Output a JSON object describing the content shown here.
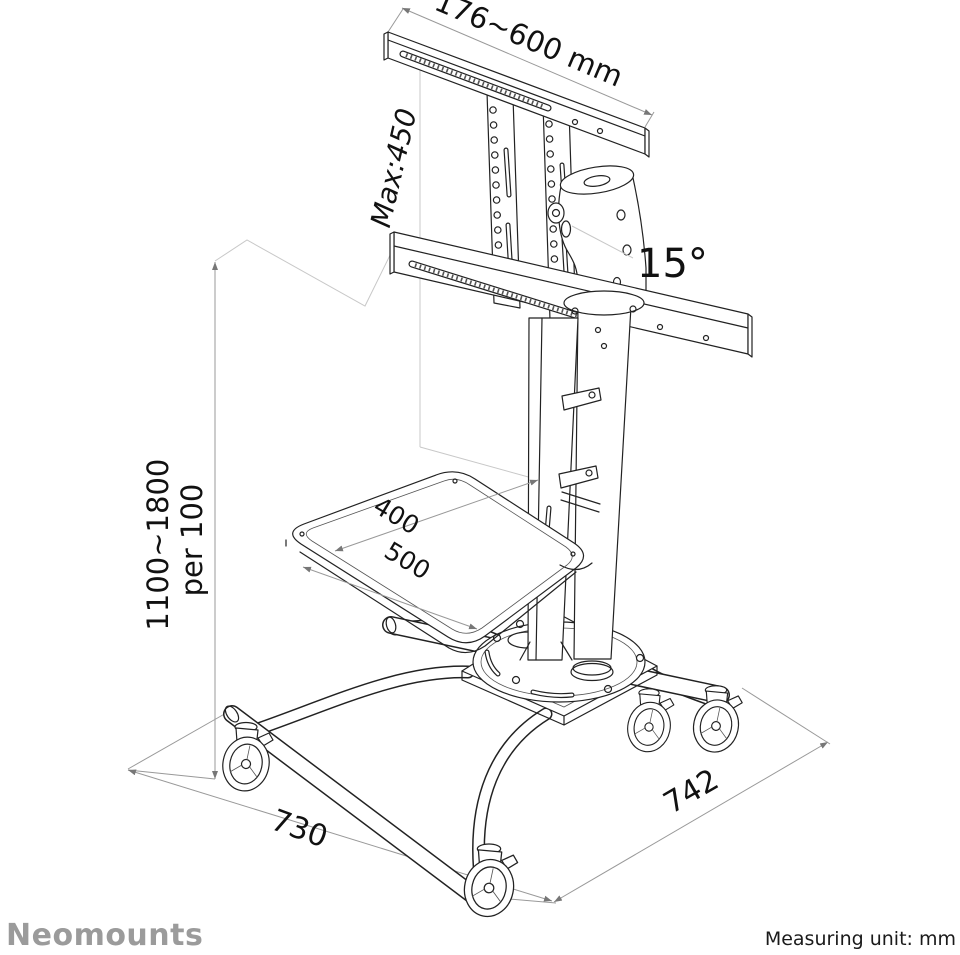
{
  "diagram": {
    "dimensions": {
      "bracket_width": "176~600 mm",
      "bracket_max_height": "Max:450",
      "tilt_angle": "15°",
      "height_range": "1100~1800",
      "height_step": "per 100",
      "shelf_depth": "400",
      "shelf_width": "500",
      "base_side_left": "730",
      "base_side_right": "742"
    }
  },
  "footer": {
    "brand": "Neomounts",
    "measuring_unit_label": "Measuring unit: mm"
  },
  "colors": {
    "line": "#222222",
    "dimension_line": "#999999",
    "extension_line": "#c8c8c8",
    "label_text": "#111111",
    "brand_gray": "#9b9b9b",
    "background": "#ffffff"
  }
}
